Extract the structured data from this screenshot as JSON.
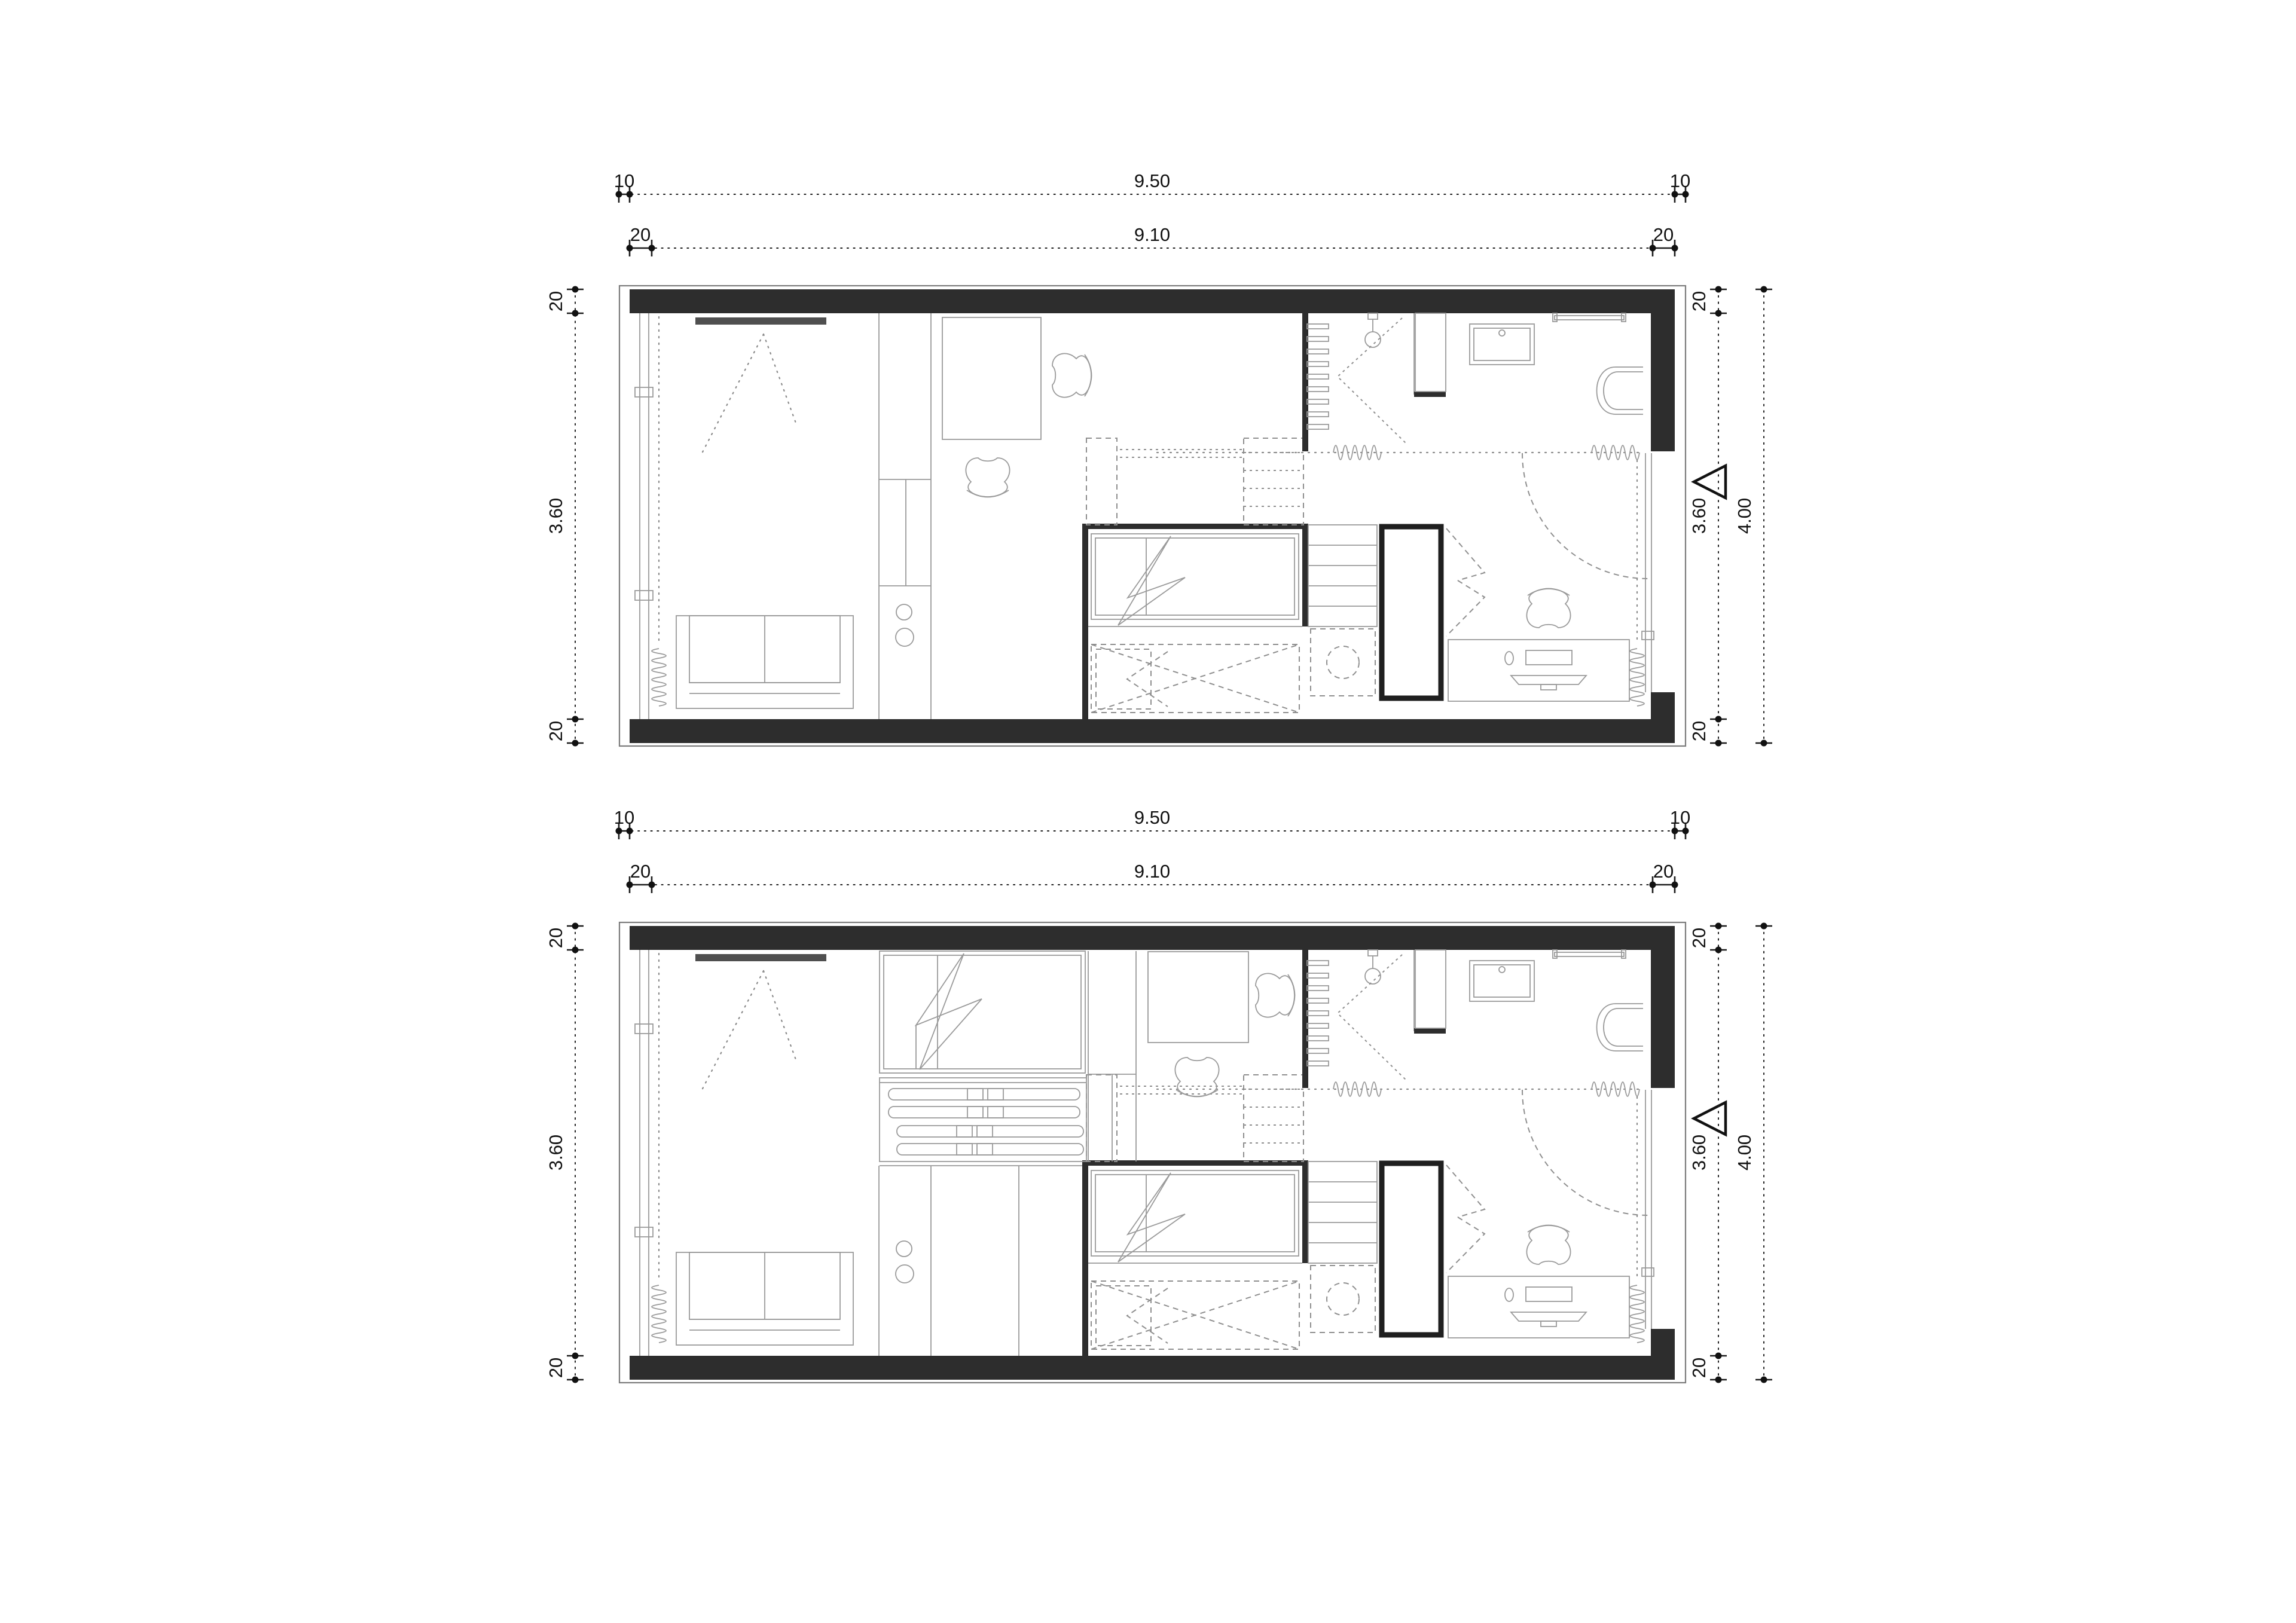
{
  "drawing": {
    "type": "architectural-floor-plan",
    "sheet_background": "#ffffff",
    "colors": {
      "wall_fill": "#2d2d2d",
      "dimension_ink": "#111111",
      "furniture_line": "#9a9a9a",
      "tv_fill": "#4f4f4f"
    },
    "plans": [
      {
        "id": "unit-plan-upper",
        "dims": {
          "h_outer": {
            "left": "10",
            "center": "9.50",
            "right": "10"
          },
          "h_inner": {
            "left": "20",
            "center": "9.10",
            "right": "20"
          },
          "v_left": {
            "top": "20",
            "center": "3.60",
            "bottom": "20"
          },
          "v_right": {
            "top": "20",
            "center": "3.60",
            "bottom": "20"
          },
          "v_total": "4.00"
        }
      },
      {
        "id": "unit-plan-lower",
        "dims": {
          "h_outer": {
            "left": "10",
            "center": "9.50",
            "right": "10"
          },
          "h_inner": {
            "left": "20",
            "center": "9.10",
            "right": "20"
          },
          "v_left": {
            "top": "20",
            "center": "3.60",
            "bottom": "20"
          },
          "v_right": {
            "top": "20",
            "center": "3.60",
            "bottom": "20"
          },
          "v_total": "4.00"
        }
      }
    ]
  }
}
